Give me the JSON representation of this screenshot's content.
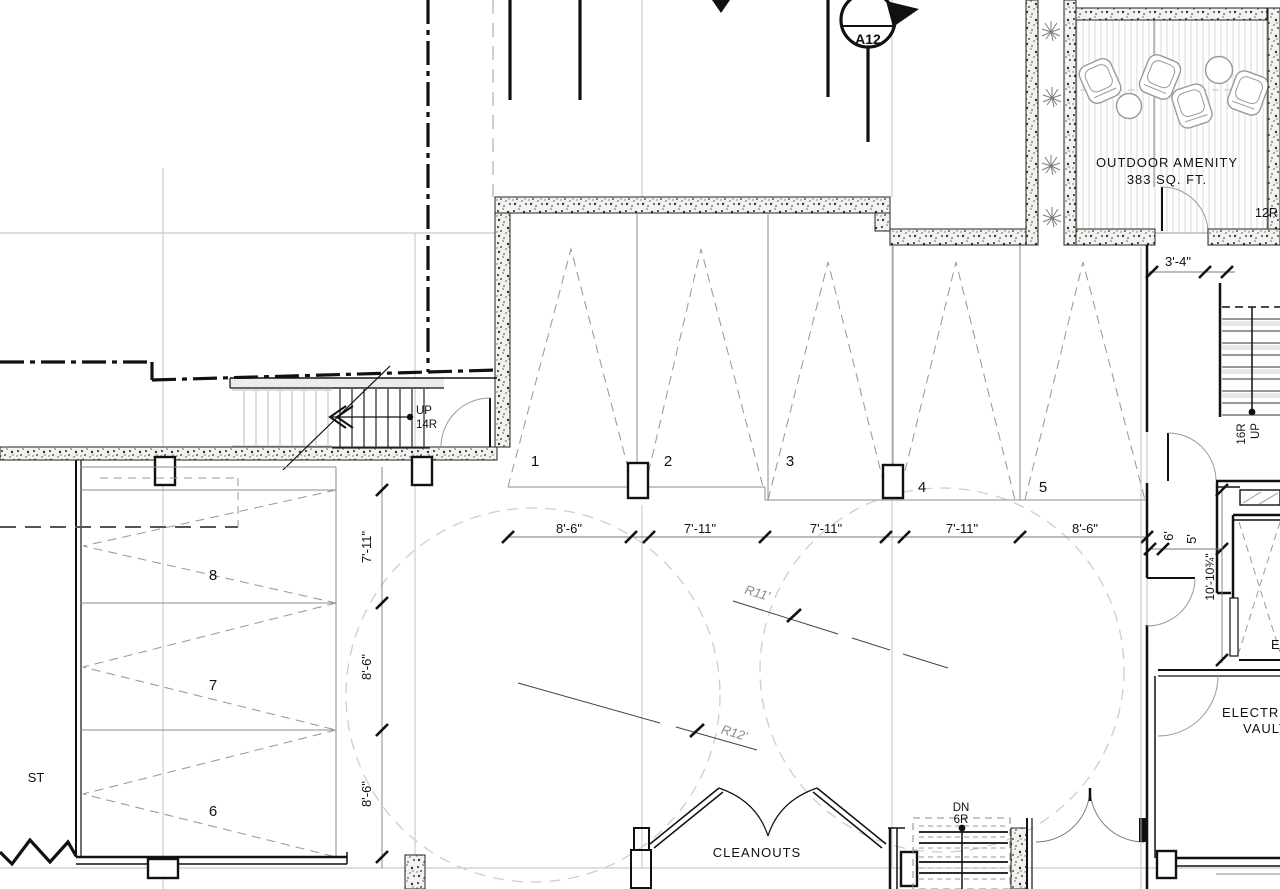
{
  "markers": {
    "section": "A12",
    "amenity_risers": "12R"
  },
  "amenity": {
    "title": "OUTDOOR AMENITY",
    "area": "383 SQ. FT."
  },
  "stairs": {
    "up_left": {
      "line1": "UP",
      "line2": "14R"
    },
    "up_right": {
      "line1": "16R",
      "line2": "UP"
    },
    "down_right": {
      "line1": "DN",
      "line2": "6R"
    }
  },
  "parking": {
    "top_numbers": [
      "1",
      "2",
      "3",
      "4",
      "5"
    ],
    "top_widths": [
      "8'-6\"",
      "7'-11\"",
      "7'-11\"",
      "7'-11\"",
      "8'-6\""
    ],
    "left_numbers": [
      "8",
      "7",
      "6"
    ],
    "left_widths": [
      "7'-11\"",
      "8'-6\"",
      "8'-6\""
    ]
  },
  "dimensions": {
    "entry_width": "3'-4\"",
    "clear_6": "6'",
    "clear_5": "5'",
    "elevator_depth": "10'-10¾\"",
    "radius_11": "R11'",
    "radius_12": "R12'"
  },
  "labels": {
    "cleanouts": "CLEANOUTS",
    "electric": "ELECTRIC",
    "vault": "VAULT",
    "street_stub": "ST",
    "elevator_stub": "E"
  }
}
